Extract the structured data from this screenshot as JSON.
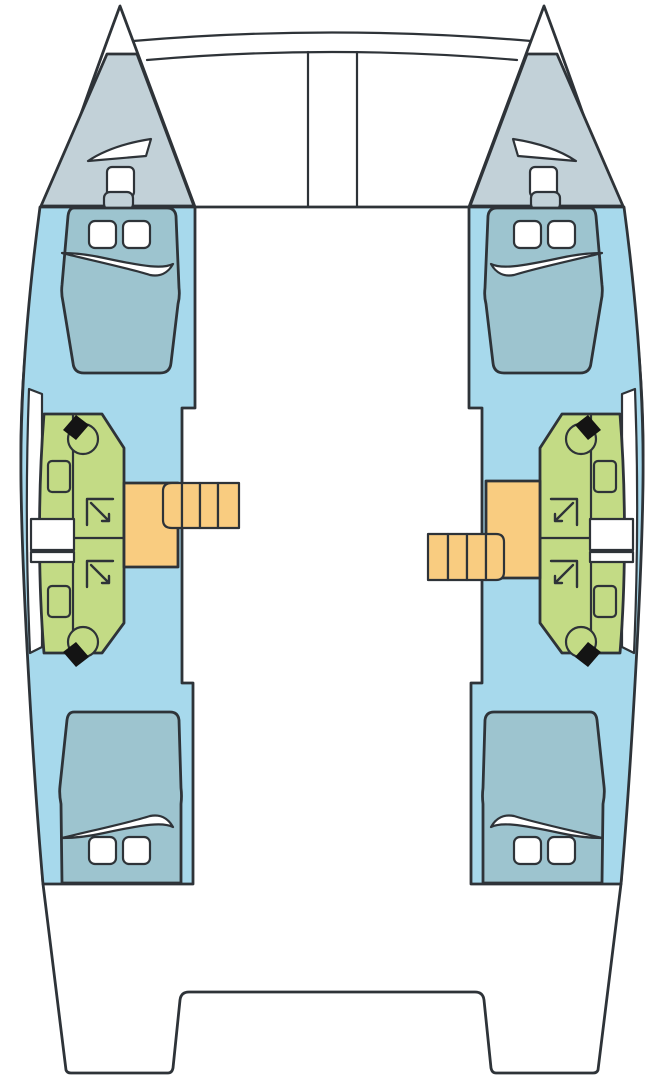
{
  "diagram": {
    "type": "catamaran-deck-layout-plan",
    "view": "top-down",
    "orientation": "bow-up",
    "hulls": [
      "port",
      "starboard"
    ],
    "counts": {
      "double-cabins": 4,
      "bathrooms": 4,
      "toilets": 4,
      "sinks": 4,
      "shower-symbols": 4,
      "companionway-stairs": 2,
      "bow-hatches": 4,
      "pillows": 8
    },
    "features_per_hull": [
      "bow-sail-locker",
      "forward-double-berth",
      "forward-head",
      "aft-head",
      "companionway-stairs",
      "aft-double-berth",
      "side-hull-window"
    ]
  },
  "colors": {
    "deck_white": "#ffffff",
    "hull_interior": "#a7d9ec",
    "bow_deck": "#c2d1d8",
    "bed": "#9dc4cf",
    "bathroom": "#c3db85",
    "stairs": "#f9cc80",
    "fixture_dark": "#141414",
    "pillow": "#ffffff",
    "outline": "#2e3338"
  }
}
